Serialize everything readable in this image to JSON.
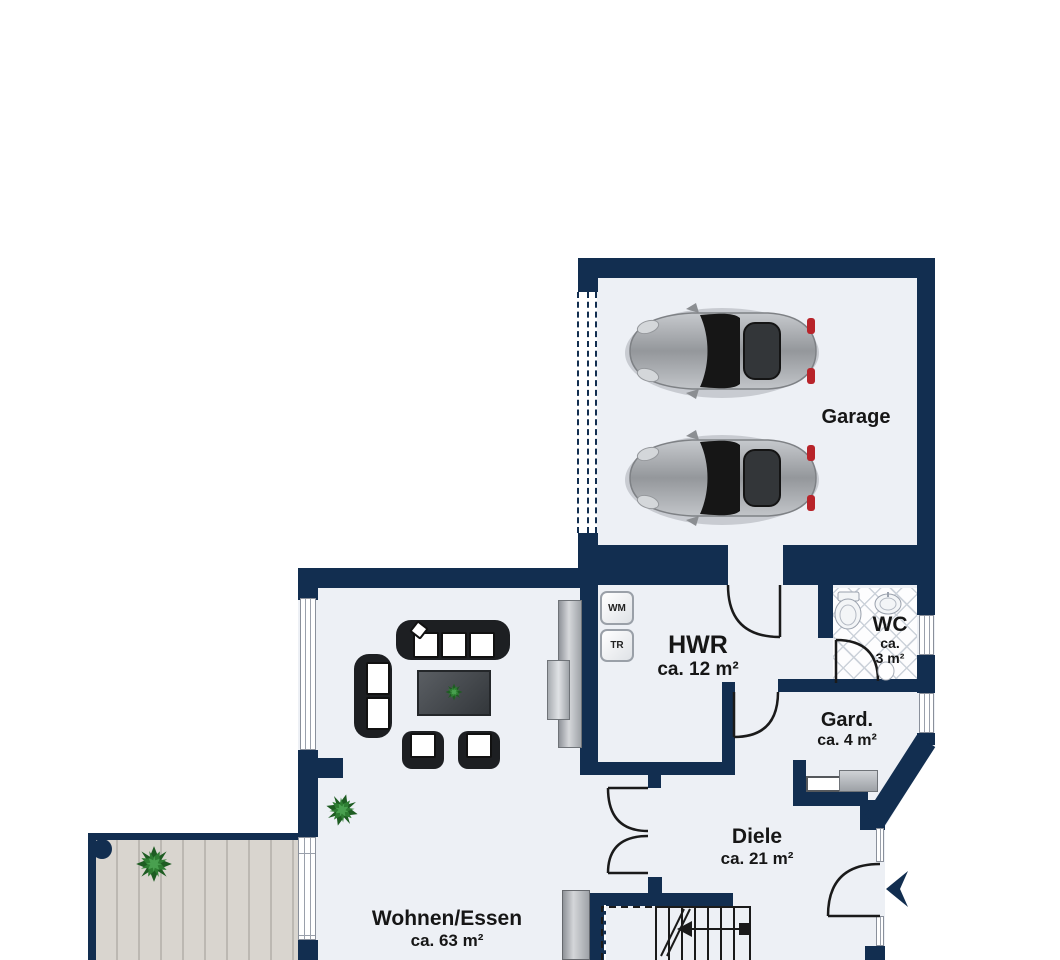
{
  "plan_title": "Erdgeschoss Grundriss",
  "colors": {
    "wall": "#122e50",
    "floor": "#edf0f5",
    "terrace_plank": "#d9d5cf",
    "tile_line": "#ccd2da",
    "plant_green": "#2e7d32",
    "taillight_red": "#b8242a"
  },
  "rooms": {
    "garage": {
      "label": "Garage"
    },
    "hwr": {
      "label": "HWR",
      "area": "ca. 12 m²"
    },
    "wc": {
      "label": "WC",
      "area_ca": "ca.",
      "area_value": "3 m²"
    },
    "gard": {
      "label": "Gard.",
      "area": "ca. 4 m²"
    },
    "diele": {
      "label": "Diele",
      "area": "ca. 21 m²"
    },
    "wohnen_essen": {
      "label": "Wohnen/Essen",
      "area": "ca. 63 m²"
    }
  },
  "appliances": {
    "washing_machine": "WM",
    "dryer": "TR"
  },
  "icons": {
    "cars": "two-cars-top-view",
    "entry_arrow": "entrance-direction-arrow",
    "plants": "potted-plant"
  }
}
